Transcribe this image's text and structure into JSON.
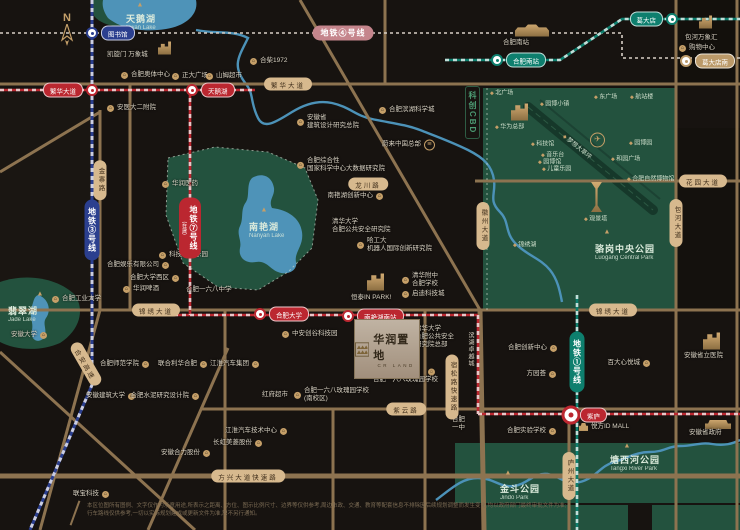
{
  "compass": {
    "n": "N"
  },
  "landmark": {
    "zh": "华润置地",
    "en": "CR LAND"
  },
  "science_label": {
    "text": "科创CBD"
  },
  "vertical_labels": [
    {
      "text": "滨湖卓越城",
      "x": 466,
      "y": 332
    }
  ],
  "colors": {
    "bg": "#171310",
    "road": "#8d7350",
    "park": "#23523e",
    "lake": "#4e93b8",
    "gold": "#c59f68",
    "line1": "#0e7f6e",
    "line3": "#2b3f8f",
    "line4": "#c5858c",
    "line7": "#bb2730"
  },
  "metro": {
    "lines": [
      {
        "t": "地铁④号线",
        "x": 343,
        "y": 33,
        "cls": "l4bg",
        "vert": false
      },
      {
        "t": "地铁③号线",
        "x": 92,
        "y": 230,
        "cls": "l3bg",
        "vert": true
      },
      {
        "t": "地铁⑦号线",
        "sub": "(在建)",
        "x": 190,
        "y": 228,
        "cls": "l7bg",
        "vert": true
      },
      {
        "t": "地铁①号线",
        "x": 577,
        "y": 362,
        "cls": "l1bg",
        "vert": true
      }
    ],
    "stations": [
      {
        "t": "图书馆",
        "x": 92,
        "y": 33,
        "cls": "l3bg"
      },
      {
        "t": "繁华大道",
        "x": 92,
        "y": 90,
        "cls": "l7bg",
        "side": "left"
      },
      {
        "t": "天鹅湖",
        "x": 192,
        "y": 90,
        "cls": "l7bg"
      },
      {
        "t": "合肥大学",
        "x": 260,
        "y": 314,
        "cls": "l7bg"
      },
      {
        "t": "南艳湖南站",
        "x": 348,
        "y": 316,
        "cls": "l7bg"
      },
      {
        "t": "紫庐",
        "x": 571,
        "y": 415,
        "cls": "l7bg",
        "big": true
      },
      {
        "t": "合肥南站",
        "x": 497,
        "y": 60,
        "cls": "l1bg"
      },
      {
        "t": "葛大店",
        "x": 672,
        "y": 19,
        "cls": "l1bg",
        "side": "left"
      },
      {
        "t": "葛大店南",
        "x": 686,
        "y": 61,
        "cls": "tanbg"
      }
    ]
  },
  "roads": [
    {
      "t": "繁华大道",
      "x": 288,
      "y": 84
    },
    {
      "t": "锦绣大道",
      "x": 156,
      "y": 310
    },
    {
      "t": "锦绣大道",
      "x": 613,
      "y": 310
    },
    {
      "t": "紫云路",
      "x": 406,
      "y": 409
    },
    {
      "t": "方兴大道快速路",
      "x": 248,
      "y": 476
    },
    {
      "t": "花园大道",
      "x": 703,
      "y": 181
    },
    {
      "t": "龙川路",
      "x": 368,
      "y": 184
    },
    {
      "t": "庐州大道",
      "x": 569,
      "y": 476,
      "vert": true
    },
    {
      "t": "包河大道",
      "x": 676,
      "y": 223,
      "vert": true
    },
    {
      "t": "徽州大道",
      "x": 483,
      "y": 226,
      "vert": true
    },
    {
      "t": "宿松路快速路",
      "x": 452,
      "y": 387,
      "vert": true
    },
    {
      "t": "金寨路",
      "x": 100,
      "y": 180,
      "vert": true
    },
    {
      "t": "合安高速",
      "x": 86,
      "y": 364,
      "rot": 60
    }
  ],
  "parks": {
    "titles": [
      {
        "zh": "天鹅湖",
        "en": "Swan Lake",
        "x": 126,
        "y": 12,
        "tx": 140,
        "ty": 5
      },
      {
        "zh": "南艳湖",
        "en": "Nanyan Lake",
        "x": 249,
        "y": 220,
        "tx": 264,
        "ty": 210
      },
      {
        "zh": "翡翠湖",
        "en": "Jade Lake",
        "x": 8,
        "y": 304,
        "tx": 40,
        "ty": 294
      },
      {
        "zh": "骆岗中央公园",
        "en": "Luogang Central Park",
        "x": 595,
        "y": 242,
        "tx": 607,
        "ty": 232
      },
      {
        "zh": "塘西河公园",
        "en": "Tangxi River Park",
        "x": 610,
        "y": 453,
        "tx": 627,
        "ty": 446
      },
      {
        "zh": "金斗公园",
        "en": "Jindo Park",
        "x": 500,
        "y": 482,
        "tx": 508,
        "ty": 473
      }
    ],
    "small": [
      {
        "t": "北广场",
        "x": 490,
        "y": 92
      },
      {
        "t": "园博小镇",
        "x": 540,
        "y": 103
      },
      {
        "t": "东广场",
        "x": 594,
        "y": 96
      },
      {
        "t": "航站楼",
        "x": 630,
        "y": 96
      },
      {
        "t": "科技馆",
        "x": 531,
        "y": 143
      },
      {
        "t": "音乐台",
        "x": 541,
        "y": 154
      },
      {
        "t": "园博馆",
        "x": 538,
        "y": 161
      },
      {
        "t": "儿童乐园",
        "x": 542,
        "y": 168
      },
      {
        "t": "园博园",
        "x": 629,
        "y": 142
      },
      {
        "t": "和园广场",
        "x": 611,
        "y": 158
      },
      {
        "t": "合肥自然博物馆",
        "x": 627,
        "y": 178
      },
      {
        "t": "锦绣湖",
        "x": 513,
        "y": 244
      },
      {
        "t": "观景塔",
        "x": 584,
        "y": 218
      },
      {
        "t": "华为总部",
        "x": 495,
        "y": 126
      },
      {
        "t": "梦想大草坪",
        "x": 560,
        "y": 146,
        "rot": 40
      }
    ]
  },
  "pois": [
    {
      "icon": "building",
      "x": 163,
      "y": 48,
      "lines": []
    },
    {
      "icon": "none",
      "x": 112,
      "y": 55,
      "lines": [
        "凯旋门 万象城"
      ]
    },
    {
      "icon": "dot",
      "x": 126,
      "y": 75,
      "lines": [
        "合肥奥体中心"
      ]
    },
    {
      "icon": "dot",
      "x": 177,
      "y": 76,
      "lines": [
        "正大广场"
      ]
    },
    {
      "icon": "dot",
      "x": 211,
      "y": 76,
      "lines": [
        "山姆超市"
      ]
    },
    {
      "icon": "dot",
      "x": 112,
      "y": 108,
      "lines": [
        "安医大二附院"
      ]
    },
    {
      "icon": "dot",
      "x": 255,
      "y": 61,
      "lines": [
        "合柴1972"
      ]
    },
    {
      "icon": "terminal",
      "x": 520,
      "y": 30,
      "lines": []
    },
    {
      "icon": "none",
      "x": 508,
      "y": 43,
      "lines": [
        "合肥南站"
      ]
    },
    {
      "icon": "building",
      "x": 704,
      "y": 22,
      "lines": []
    },
    {
      "icon": "none",
      "x": 690,
      "y": 38,
      "lines": [
        "包河万象汇"
      ]
    },
    {
      "icon": "dot",
      "x": 684,
      "y": 48,
      "lines": [
        "购物中心"
      ]
    },
    {
      "icon": "dot",
      "x": 384,
      "y": 110,
      "lines": [
        "合肥滨湖科学城"
      ]
    },
    {
      "icon": "dot",
      "x": 302,
      "y": 122,
      "lines": [
        "安徽省",
        "建筑设计研究总院"
      ]
    },
    {
      "icon": "nio",
      "x": 440,
      "y": 145,
      "side": "left",
      "lines": [
        "蔚来中国总部"
      ]
    },
    {
      "icon": "dot",
      "x": 302,
      "y": 165,
      "lines": [
        "合肥综合性",
        "国家科学中心大数据研究院"
      ]
    },
    {
      "icon": "dot",
      "x": 167,
      "y": 184,
      "lines": [
        "华润医药"
      ]
    },
    {
      "icon": "dot",
      "x": 388,
      "y": 196,
      "side": "left",
      "lines": [
        "南艳湖创新中心"
      ]
    },
    {
      "icon": "dot",
      "x": 164,
      "y": 255,
      "lines": [
        "科技创新乐园"
      ]
    },
    {
      "icon": "none",
      "x": 337,
      "y": 226,
      "lines": [
        "清华大学",
        "合肥公共安全研究院"
      ]
    },
    {
      "icon": "dot",
      "x": 362,
      "y": 245,
      "lines": [
        "哈工大",
        "机器人国际创新研究院"
      ]
    },
    {
      "icon": "bigbuilding",
      "x": 372,
      "y": 282,
      "lines": []
    },
    {
      "icon": "none",
      "x": 356,
      "y": 298,
      "lines": [
        "恒泰IN PARK!"
      ]
    },
    {
      "icon": "dot",
      "x": 407,
      "y": 280,
      "lines": [
        "清华附中",
        "合肥学校"
      ]
    },
    {
      "icon": "dot",
      "x": 407,
      "y": 294,
      "lines": [
        "启迪科技城"
      ]
    },
    {
      "icon": "dot",
      "x": 57,
      "y": 299,
      "lines": [
        "合肥工业大学"
      ]
    },
    {
      "icon": "dot",
      "x": 52,
      "y": 335,
      "side": "left",
      "lines": [
        "安徽大学"
      ]
    },
    {
      "icon": "dot",
      "x": 174,
      "y": 265,
      "side": "left",
      "lines": [
        "合肥娱乐有限公司"
      ]
    },
    {
      "icon": "dot",
      "x": 184,
      "y": 278,
      "side": "left",
      "lines": [
        "合肥大学西区"
      ]
    },
    {
      "icon": "dot",
      "x": 128,
      "y": 289,
      "lines": [
        "华润啤酒"
      ]
    },
    {
      "icon": "none",
      "x": 191,
      "y": 290,
      "lines": [
        "合肥一六八中学"
      ]
    },
    {
      "icon": "dot",
      "x": 287,
      "y": 334,
      "lines": [
        "中安创谷科技园"
      ]
    },
    {
      "icon": "none",
      "x": 420,
      "y": 337,
      "lines": [
        "清华大学",
        "合肥公共安全",
        "研究院总部"
      ]
    },
    {
      "icon": "dot",
      "x": 433,
      "y": 372,
      "lines": []
    },
    {
      "icon": "none",
      "x": 378,
      "y": 380,
      "lines": [
        "合肥一六八玫瑰园学校"
      ]
    },
    {
      "icon": "dot",
      "x": 299,
      "y": 395,
      "lines": [
        "合肥一六八玫瑰园学校",
        "(南校区)"
      ]
    },
    {
      "icon": "none",
      "x": 293,
      "y": 395,
      "side": "left",
      "lines": [
        "红府超市"
      ]
    },
    {
      "icon": "dot",
      "x": 154,
      "y": 364,
      "side": "left",
      "lines": [
        "合肥师范学院"
      ]
    },
    {
      "icon": "dot",
      "x": 212,
      "y": 364,
      "side": "left",
      "lines": [
        "联合利华合肥"
      ]
    },
    {
      "icon": "dot",
      "x": 264,
      "y": 364,
      "side": "left",
      "lines": [
        "江淮汽车集团"
      ]
    },
    {
      "icon": "dot",
      "x": 140,
      "y": 396,
      "side": "left",
      "lines": [
        "安徽建筑大学"
      ]
    },
    {
      "icon": "dot",
      "x": 204,
      "y": 396,
      "side": "left",
      "lines": [
        "合肥水泥研究设计院"
      ]
    },
    {
      "icon": "dot",
      "x": 292,
      "y": 431,
      "side": "left",
      "lines": [
        "江淮汽车技术中心"
      ]
    },
    {
      "icon": "dot",
      "x": 267,
      "y": 443,
      "side": "left",
      "lines": [
        "长虹美菱股份"
      ]
    },
    {
      "icon": "dot",
      "x": 215,
      "y": 453,
      "side": "left",
      "lines": [
        "安徽合力股份"
      ]
    },
    {
      "icon": "dot",
      "x": 114,
      "y": 494,
      "side": "left",
      "lines": [
        "联宝科技"
      ]
    },
    {
      "icon": "none",
      "x": 457,
      "y": 424,
      "lines": [
        "合肥",
        "一中"
      ]
    },
    {
      "icon": "dot",
      "x": 561,
      "y": 431,
      "side": "left",
      "lines": [
        "合肥实验学校"
      ]
    },
    {
      "icon": "dot",
      "x": 562,
      "y": 348,
      "side": "left",
      "lines": [
        "合肥创新中心"
      ]
    },
    {
      "icon": "dot",
      "x": 561,
      "y": 374,
      "side": "left",
      "lines": [
        "方园荟"
      ]
    },
    {
      "icon": "dot",
      "x": 655,
      "y": 363,
      "side": "left",
      "lines": [
        "百大心悦城"
      ]
    },
    {
      "icon": "mall",
      "x": 584,
      "y": 427,
      "lines": [
        "悦方ID MALL"
      ]
    },
    {
      "icon": "bigbuilding",
      "x": 708,
      "y": 341,
      "lines": []
    },
    {
      "icon": "none",
      "x": 689,
      "y": 356,
      "lines": [
        "安徽省立医院"
      ]
    },
    {
      "icon": "gov",
      "x": 710,
      "y": 424,
      "lines": []
    },
    {
      "icon": "none",
      "x": 694,
      "y": 433,
      "lines": [
        "安徽省政府"
      ]
    },
    {
      "icon": "bigbuilding",
      "x": 516,
      "y": 112,
      "lines": []
    },
    {
      "icon": "plane",
      "x": 595,
      "y": 140,
      "lines": []
    },
    {
      "icon": "tower",
      "x": 596,
      "y": 197,
      "lines": []
    }
  ],
  "disclaimer": {
    "line1": "本区位图所有图例、文字仅作为示意用途,所表示之距离、方位、图示比例尺寸、边界等仅供参考,周边市政、交通、教育等配套信息不排除因后续规划调整而发生变化,均以政府部门最终审批文件为准;",
    "line2": "行车路线仅供参考,一切以实际规划建成或更新文件为准,恕不另行通知。"
  }
}
